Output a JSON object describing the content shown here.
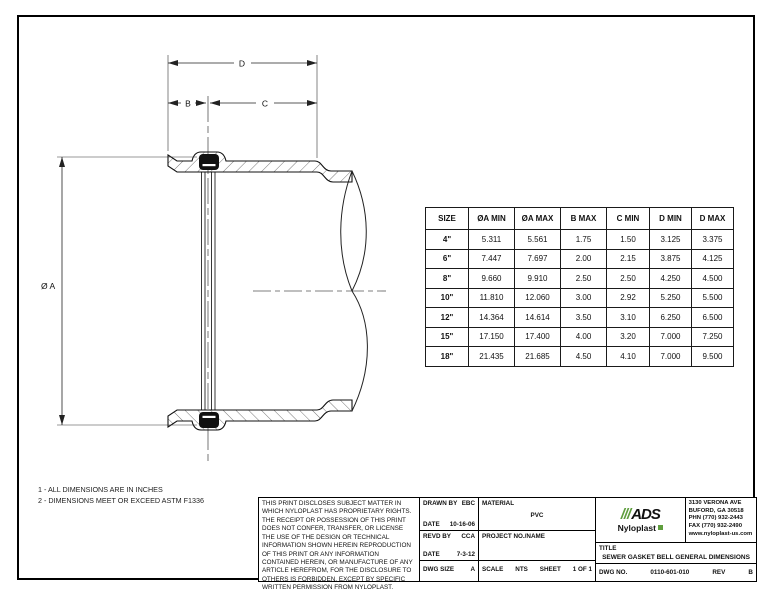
{
  "notes": {
    "line1": "1  -  ALL DIMENSIONS ARE IN INCHES",
    "line2": "2  -  DIMENSIONS MEET OR EXCEED ASTM F1336"
  },
  "drawing": {
    "dim_d": "D",
    "dim_b": "B",
    "dim_c": "C",
    "dim_diameter": "Ø A"
  },
  "table": {
    "columns": [
      "SIZE",
      "ØA MIN",
      "ØA MAX",
      "B MAX",
      "C MIN",
      "D MIN",
      "D MAX"
    ],
    "rows": [
      [
        "4\"",
        "5.311",
        "5.561",
        "1.75",
        "1.50",
        "3.125",
        "3.375"
      ],
      [
        "6\"",
        "7.447",
        "7.697",
        "2.00",
        "2.15",
        "3.875",
        "4.125"
      ],
      [
        "8\"",
        "9.660",
        "9.910",
        "2.50",
        "2.50",
        "4.250",
        "4.500"
      ],
      [
        "10\"",
        "11.810",
        "12.060",
        "3.00",
        "2.92",
        "5.250",
        "5.500"
      ],
      [
        "12\"",
        "14.364",
        "14.614",
        "3.50",
        "3.10",
        "6.250",
        "6.500"
      ],
      [
        "15\"",
        "17.150",
        "17.400",
        "4.00",
        "3.20",
        "7.000",
        "7.250"
      ],
      [
        "18\"",
        "21.435",
        "21.685",
        "4.50",
        "4.10",
        "7.000",
        "9.500"
      ]
    ]
  },
  "title_block": {
    "disclaimer": "THIS PRINT DISCLOSES SUBJECT MATTER IN WHICH NYLOPLAST HAS PROPRIETARY RIGHTS.  THE RECEIPT OR POSSESSION OF THIS PRINT DOES NOT CONFER, TRANSFER, OR LICENSE THE USE OF THE DESIGN OR TECHNICAL INFORMATION SHOWN HEREIN REPRODUCTION OF THIS PRINT OR ANY INFORMATION CONTAINED HEREIN, OR MANUFACTURE OF ANY ARTICLE HEREFROM, FOR THE DISCLOSURE TO OTHERS IS FORBIDDEN, EXCEPT BY SPECIFIC WRITTEN PERMISSION FROM NYLOPLAST.",
    "drawn_by_label": "DRAWN BY",
    "drawn_by": "EBC",
    "date1_label": "DATE",
    "date1": "10-16-06",
    "revd_by_label": "REVD BY",
    "revd_by": "CCA",
    "date2_label": "DATE",
    "date2": "7-3-12",
    "dwg_size_label": "DWG SIZE",
    "dwg_size": "A",
    "material_label": "MATERIAL",
    "material": "PVC",
    "project_label": "PROJECT NO./NAME",
    "scale_label": "SCALE",
    "scale": "NTS",
    "sheet_label": "SHEET",
    "sheet": "1 OF 1",
    "title_label": "TITLE",
    "title": "SEWER GASKET BELL GENERAL DIMENSIONS",
    "dwg_no_label": "DWG NO.",
    "dwg_no": "0110-601-010",
    "rev_label": "REV",
    "rev": "B"
  },
  "company": {
    "logo_slashes": "///",
    "logo_text": "ADS",
    "logo_sub": "Nyloplast",
    "accent_green": "#5f9e3e",
    "address_lines": [
      "3130 VERONA AVE",
      "BUFORD, GA 30518",
      "PHN (770) 932-2443",
      "FAX (770) 932-2490",
      "www.nyloplast-us.com"
    ]
  }
}
